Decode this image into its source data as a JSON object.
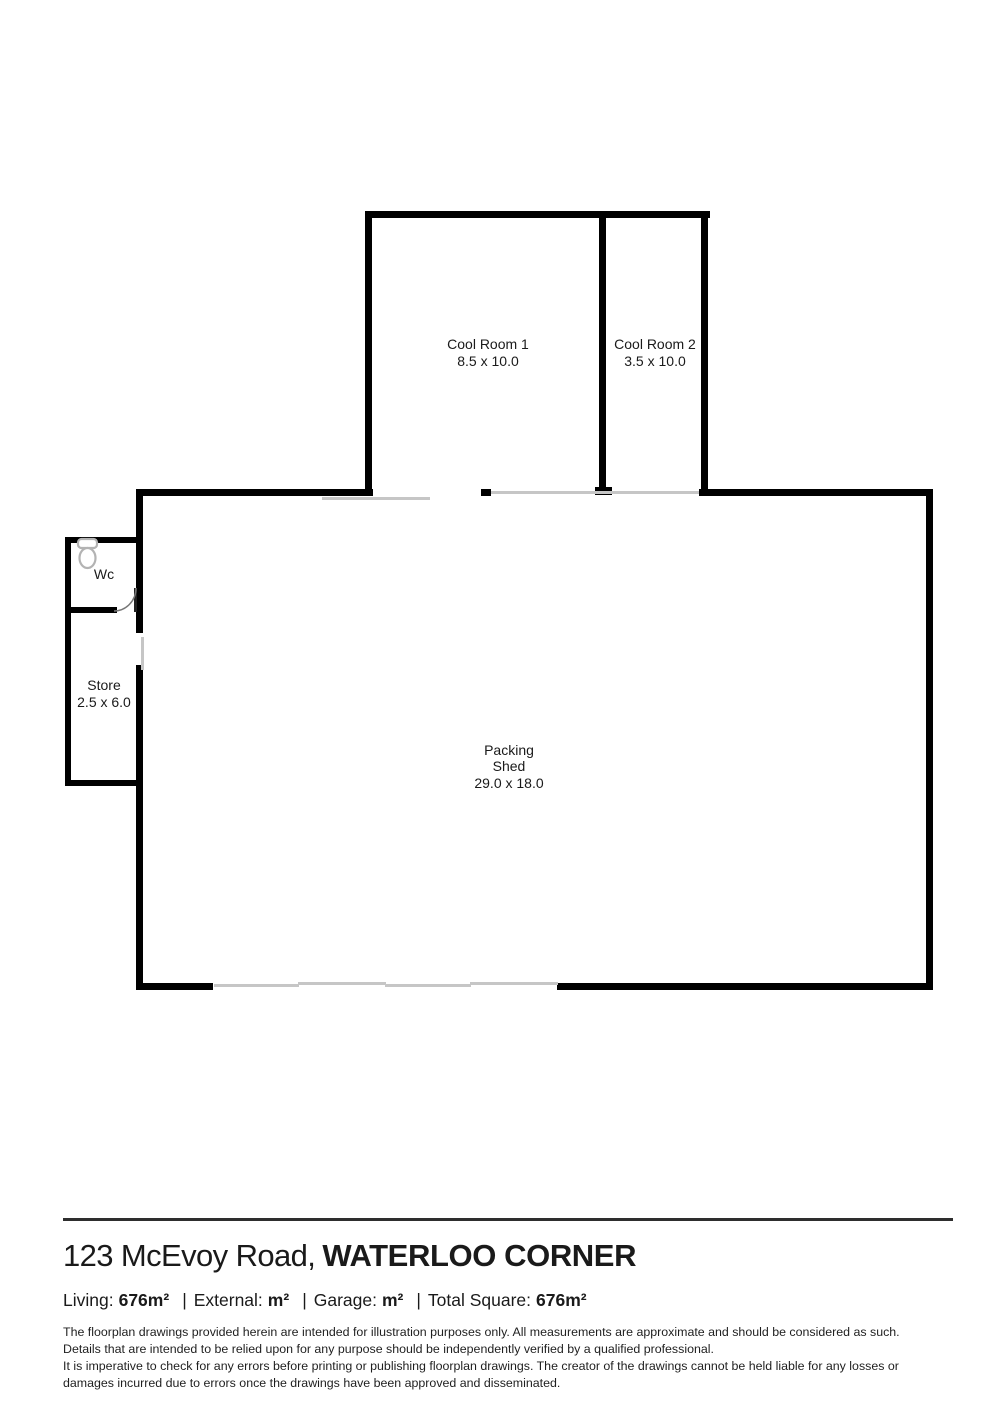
{
  "colors": {
    "wall": "#000000",
    "opening": "#c6c6c6",
    "ink": "#1a1a1a",
    "fixture": "#b3b3b3"
  },
  "floorplan": {
    "cool_room_1": {
      "name": "Cool Room 1",
      "dims": "8.5 x 10.0"
    },
    "cool_room_2": {
      "name": "Cool Room 2",
      "dims": "3.5 x 10.0"
    },
    "wc": {
      "name": "Wc",
      "fixture_icon": "toilet-icon"
    },
    "store": {
      "name": "Store",
      "dims": "2.5 x 6.0"
    },
    "packing_shed": {
      "name_line1": "Packing",
      "name_line2": "Shed",
      "dims": "29.0 x 18.0"
    }
  },
  "footer": {
    "address": "123 McEvoy Road,",
    "suburb": "WATERLOO CORNER",
    "stats": {
      "living_label": "Living:",
      "living_value": "676m²",
      "external_label": "External:",
      "external_value": "m²",
      "garage_label": "Garage:",
      "garage_value": "m²",
      "total_label": "Total Square:",
      "total_value": "676m²",
      "separator": "|"
    },
    "disclaimer1_line1": "The floorplan drawings provided herein are intended for illustration purposes only. All measurements are approximate and should be considered as such.",
    "disclaimer1_line2": "Details that are intended to be relied upon for any purpose should be independently verified by a qualified professional.",
    "disclaimer2_line1": "It is imperative to check for any errors before printing or publishing floorplan drawings. The creator of the drawings cannot be held liable for any losses or",
    "disclaimer2_line2": "damages incurred due to errors once the drawings have been approved and disseminated."
  }
}
